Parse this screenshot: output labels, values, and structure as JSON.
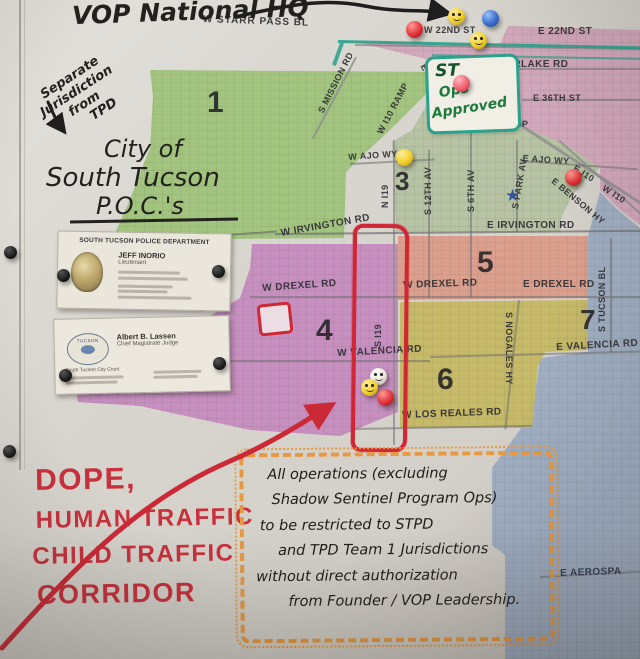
{
  "annotations": {
    "hq_label": "VOP National HQ",
    "separate_jurisdiction": {
      "line1": "Separate",
      "line2": "Jurisdiction",
      "line3": "from",
      "line4": "TPD"
    },
    "city_poc": {
      "line1": "City of",
      "line2": "South Tucson",
      "line3": "P.O.C.'s"
    },
    "st_ops": {
      "st": "ST",
      "line1": "Ops",
      "line2": "Approved"
    },
    "red_warning": {
      "line1": "DOPE,",
      "line2": "HUMAN TRAFFIC",
      "line3": "CHILD TRAFFIC",
      "line4": "CORRIDOR"
    },
    "ops_note": {
      "line1": "All operations (excluding",
      "line2": "Shadow Sentinel Program Ops)",
      "line3": "to be restricted to STPD",
      "line4": "and TPD Team 1 Jurisdictions",
      "line5": "without direct authorization",
      "line6": "from Founder / VOP Leadership."
    }
  },
  "cards": {
    "police": {
      "department": "SOUTH TUCSON POLICE DEPARTMENT",
      "name": "JEFF INORIO",
      "title": "Lieutenant"
    },
    "judge": {
      "name": "Albert B. Lassen",
      "title": "Chief Magistrate Judge",
      "org": "South Tucson City Court",
      "seal": "TUCSON"
    }
  },
  "districts": {
    "d1": "1",
    "d2": "2",
    "d3": "3",
    "d4": "4",
    "d5": "5",
    "d6": "6",
    "d7": "7"
  },
  "streets": {
    "starr_pass": "W STARR PASS BL",
    "w22": "W 22ND ST",
    "e22": "E 22ND ST",
    "silverlake": "E SILVERLAKE RD",
    "e36": "E 36TH ST",
    "w_i10_ramp_diag": "W I10 RAMP",
    "e_i10_ramp": "E I10 RAMP",
    "w_i10_ramp_h": "W I10 RAMP",
    "mission": "S MISSION RD",
    "w_ajo": "W AJO WY",
    "e_ajo": "E AJO WY",
    "e_i10": "E I10",
    "w_i10": "W I10",
    "benson": "E BENSON HY",
    "n_i19": "N I19",
    "s_12th": "S 12TH AV",
    "s_6th": "S 6TH AV",
    "s_park": "S PARK AV",
    "w_irvington": "W IRVINGTON RD",
    "e_irvington": "E IRVINGTON RD",
    "w_drexel_left": "W DREXEL RD",
    "w_drexel": "W DREXEL RD",
    "e_drexel": "E DREXEL RD",
    "tucson_bl": "S TUCSON BL",
    "s_i19": "S I19",
    "w_valencia": "W VALENCIA RD",
    "e_valencia": "E VALENCIA RD",
    "nogales": "S NOGALES HY",
    "w_los_reales": "W LOS REALES RD",
    "aerospace": "E AEROSPA"
  },
  "icons": {
    "star": "★"
  },
  "colors": {
    "district1_green": "#a2c47f",
    "district2_pink": "#d3a8bc",
    "district3_sage": "#b7c3a4",
    "district4_purple": "#c78fc0",
    "district5_salmon": "#dc9f8d",
    "district6_olive": "#c6b968",
    "district7_blue": "#a0aec3",
    "teal_boundary": "#2aa18b",
    "red_marker": "#d02734",
    "orange_marker": "#e8993f",
    "star_blue": "#35549c"
  }
}
